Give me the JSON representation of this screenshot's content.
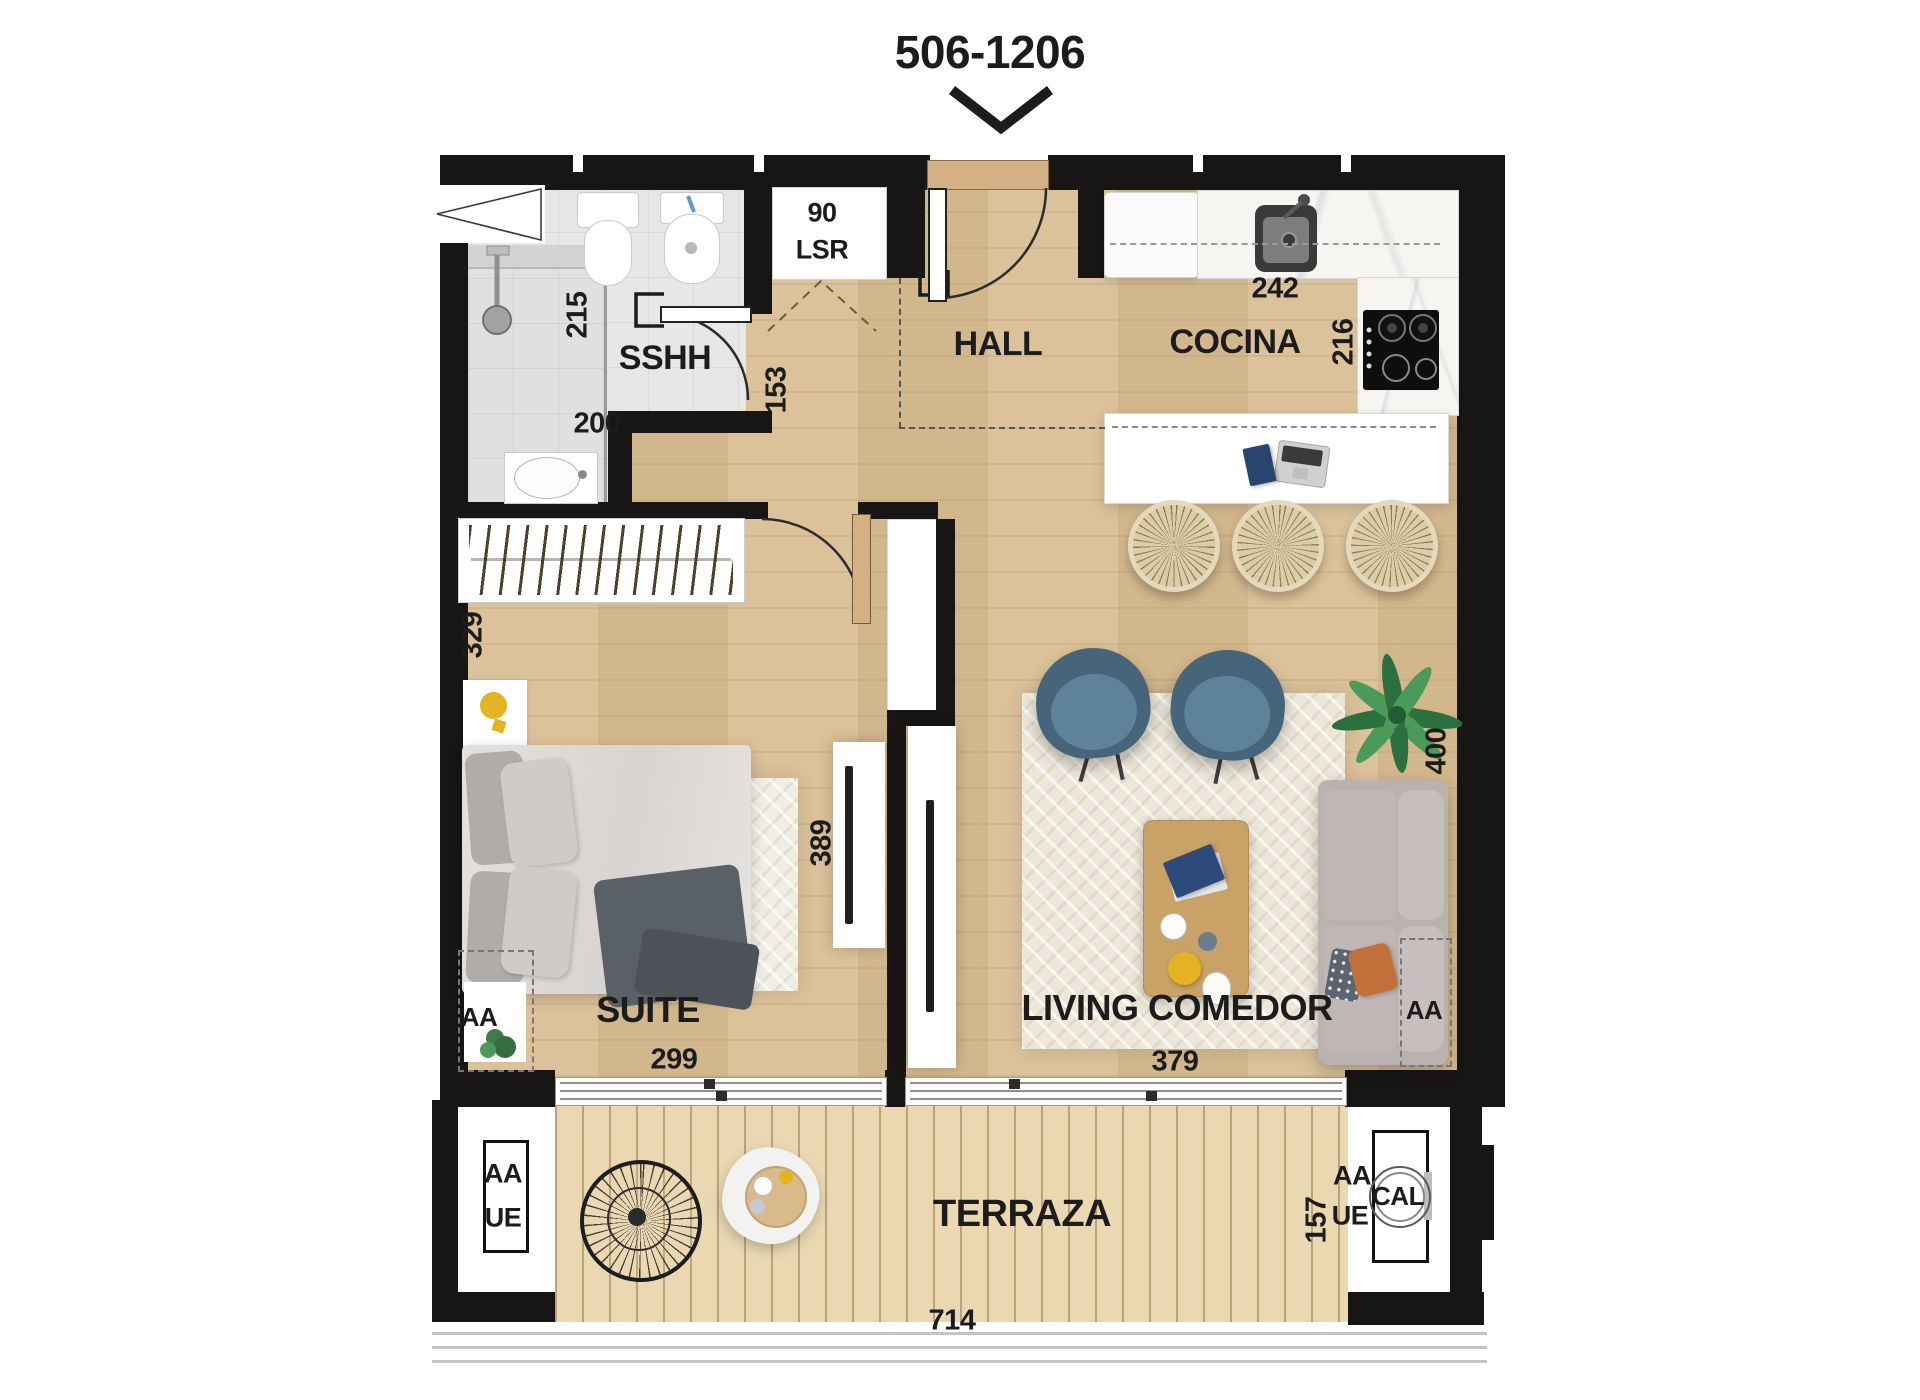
{
  "unit": {
    "title": "506-1206"
  },
  "rooms": {
    "bathroom": "SSHH",
    "hall": "HALL",
    "kitchen": "COCINA",
    "bedroom": "SUITE",
    "living": "LIVING COMEDOR",
    "terrace": "TERRAZA"
  },
  "closet": {
    "width": "90",
    "label": "LSR"
  },
  "dims": {
    "bath_width": "215",
    "bath_length": "200",
    "hall_width": "153",
    "kitchen_counter": "242",
    "kitchen_depth": "216",
    "bedroom_closet": "329",
    "bedroom_width": "299",
    "bedroom_length": "389",
    "living_width": "379",
    "living_length": "400",
    "terrace_width": "714",
    "terrace_depth": "157"
  },
  "equipment": {
    "bedroom_ac": "AA",
    "living_ac": "AA",
    "terrace_left_ac": "AA",
    "terrace_left_unit": "UE",
    "terrace_right_ac": "AA",
    "terrace_right_unit": "UE",
    "water_heater": "CAL"
  },
  "palette": {
    "wall": "#171614",
    "wood": "#d8bd92",
    "deck": "#ead8b3",
    "tile": "#e7e7e5",
    "marble": "#f6f5f2",
    "rug": "#ece7d9",
    "chair_blue": "#46647a",
    "chair_blue_light": "#5d8299",
    "sofa_gray": "#b9b2af",
    "table_wood": "#c9a268",
    "accent_yellow": "#e3b322",
    "accent_orange": "#c2703a",
    "plant_green": "#3b8049",
    "text": "#1c1c1c"
  }
}
